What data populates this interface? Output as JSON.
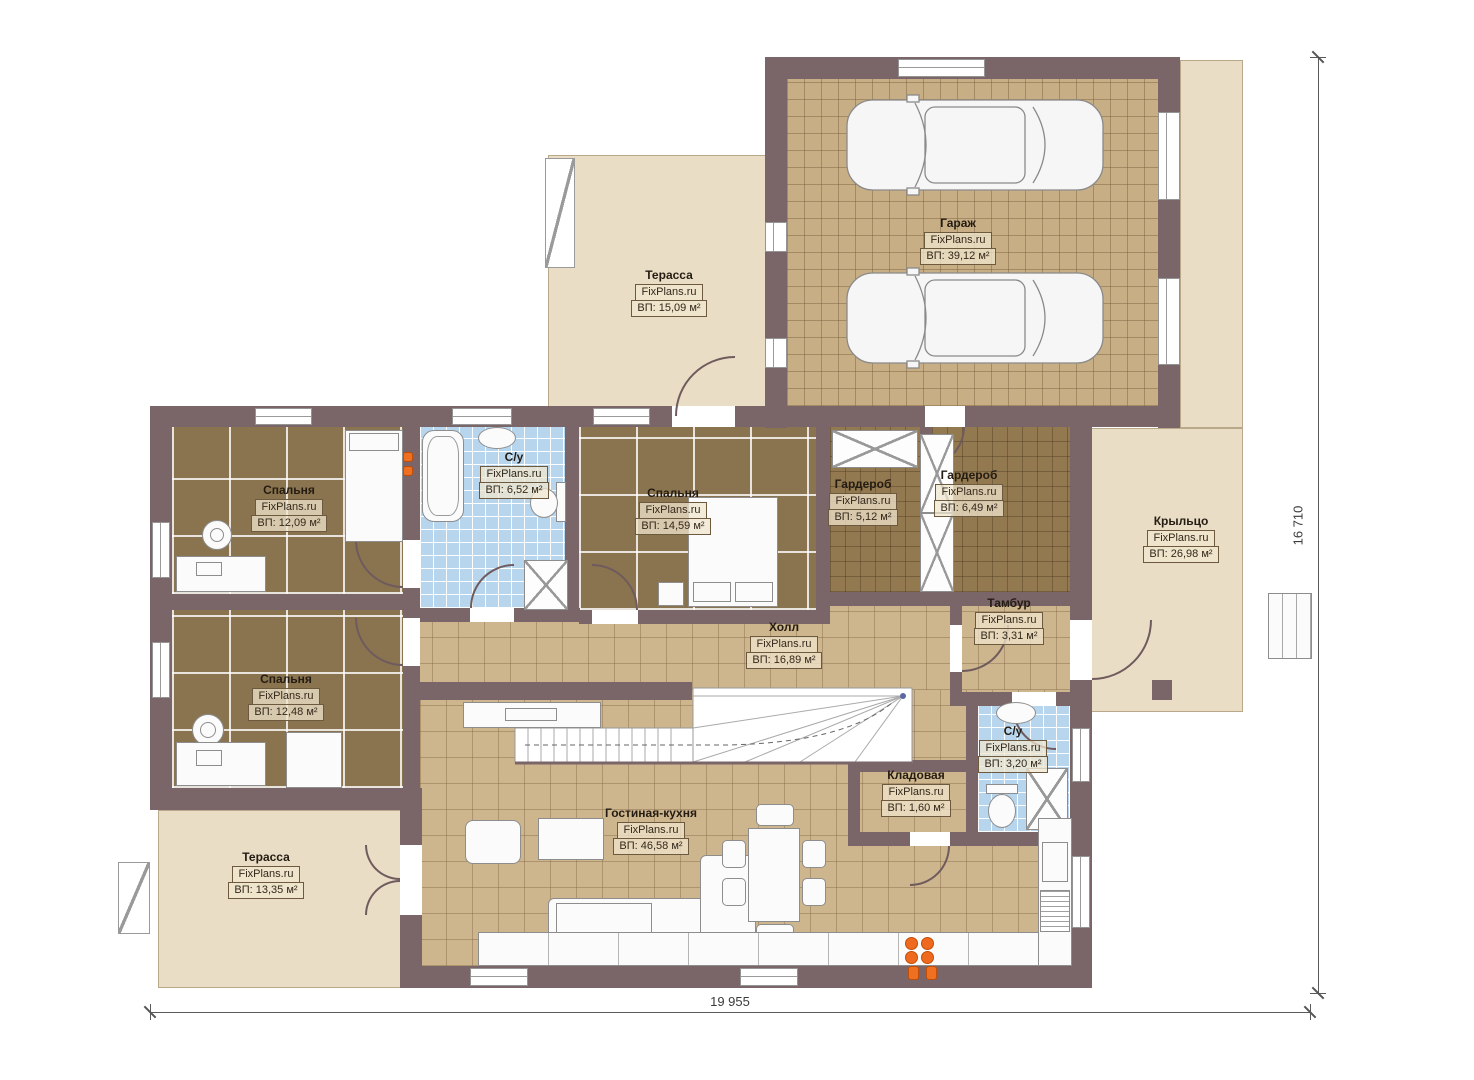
{
  "watermark": "FixPlans.ru",
  "rooms": [
    {
      "id": "garage",
      "name": "Гараж",
      "area": "ВП: 39,12 м²"
    },
    {
      "id": "terrace-top",
      "name": "Терасса",
      "area": "ВП: 15,09 м²"
    },
    {
      "id": "bedroom-1",
      "name": "Спальня",
      "area": "ВП: 12,09 м²"
    },
    {
      "id": "bathroom-1",
      "name": "С/у",
      "area": "ВП: 6,52 м²"
    },
    {
      "id": "bedroom-2",
      "name": "Спальня",
      "area": "ВП: 14,59 м²"
    },
    {
      "id": "wardrobe-1",
      "name": "Гардероб",
      "area": "ВП: 5,12 м²"
    },
    {
      "id": "wardrobe-2",
      "name": "Гардероб",
      "area": "ВП: 6,49 м²"
    },
    {
      "id": "porch",
      "name": "Крыльцо",
      "area": "ВП: 26,98 м²"
    },
    {
      "id": "hall",
      "name": "Холл",
      "area": "ВП: 16,89 м²"
    },
    {
      "id": "tambour",
      "name": "Тамбур",
      "area": "ВП: 3,31 м²"
    },
    {
      "id": "bedroom-3",
      "name": "Спальня",
      "area": "ВП: 12,48 м²"
    },
    {
      "id": "bathroom-2",
      "name": "С/у",
      "area": "ВП: 3,20 м²"
    },
    {
      "id": "storage",
      "name": "Кладовая",
      "area": "ВП: 1,60 м²"
    },
    {
      "id": "living-kitchen",
      "name": "Гостиная-кухня",
      "area": "ВП: 46,58 м²"
    },
    {
      "id": "terrace-bottom",
      "name": "Терасса",
      "area": "ВП: 13,35 м²"
    }
  ],
  "dimensions": {
    "width_label": "19 955",
    "height_label": "16 710"
  },
  "colors": {
    "wall": "#7a6568",
    "wood_floor": "#cdb58d",
    "bedroom_floor": "#8a744f",
    "wardrobe_floor": "#93794f",
    "bath_floor": "#b7d6ee",
    "terrace": "#e9ddc5",
    "accent_orange": "#ef6a1f"
  }
}
